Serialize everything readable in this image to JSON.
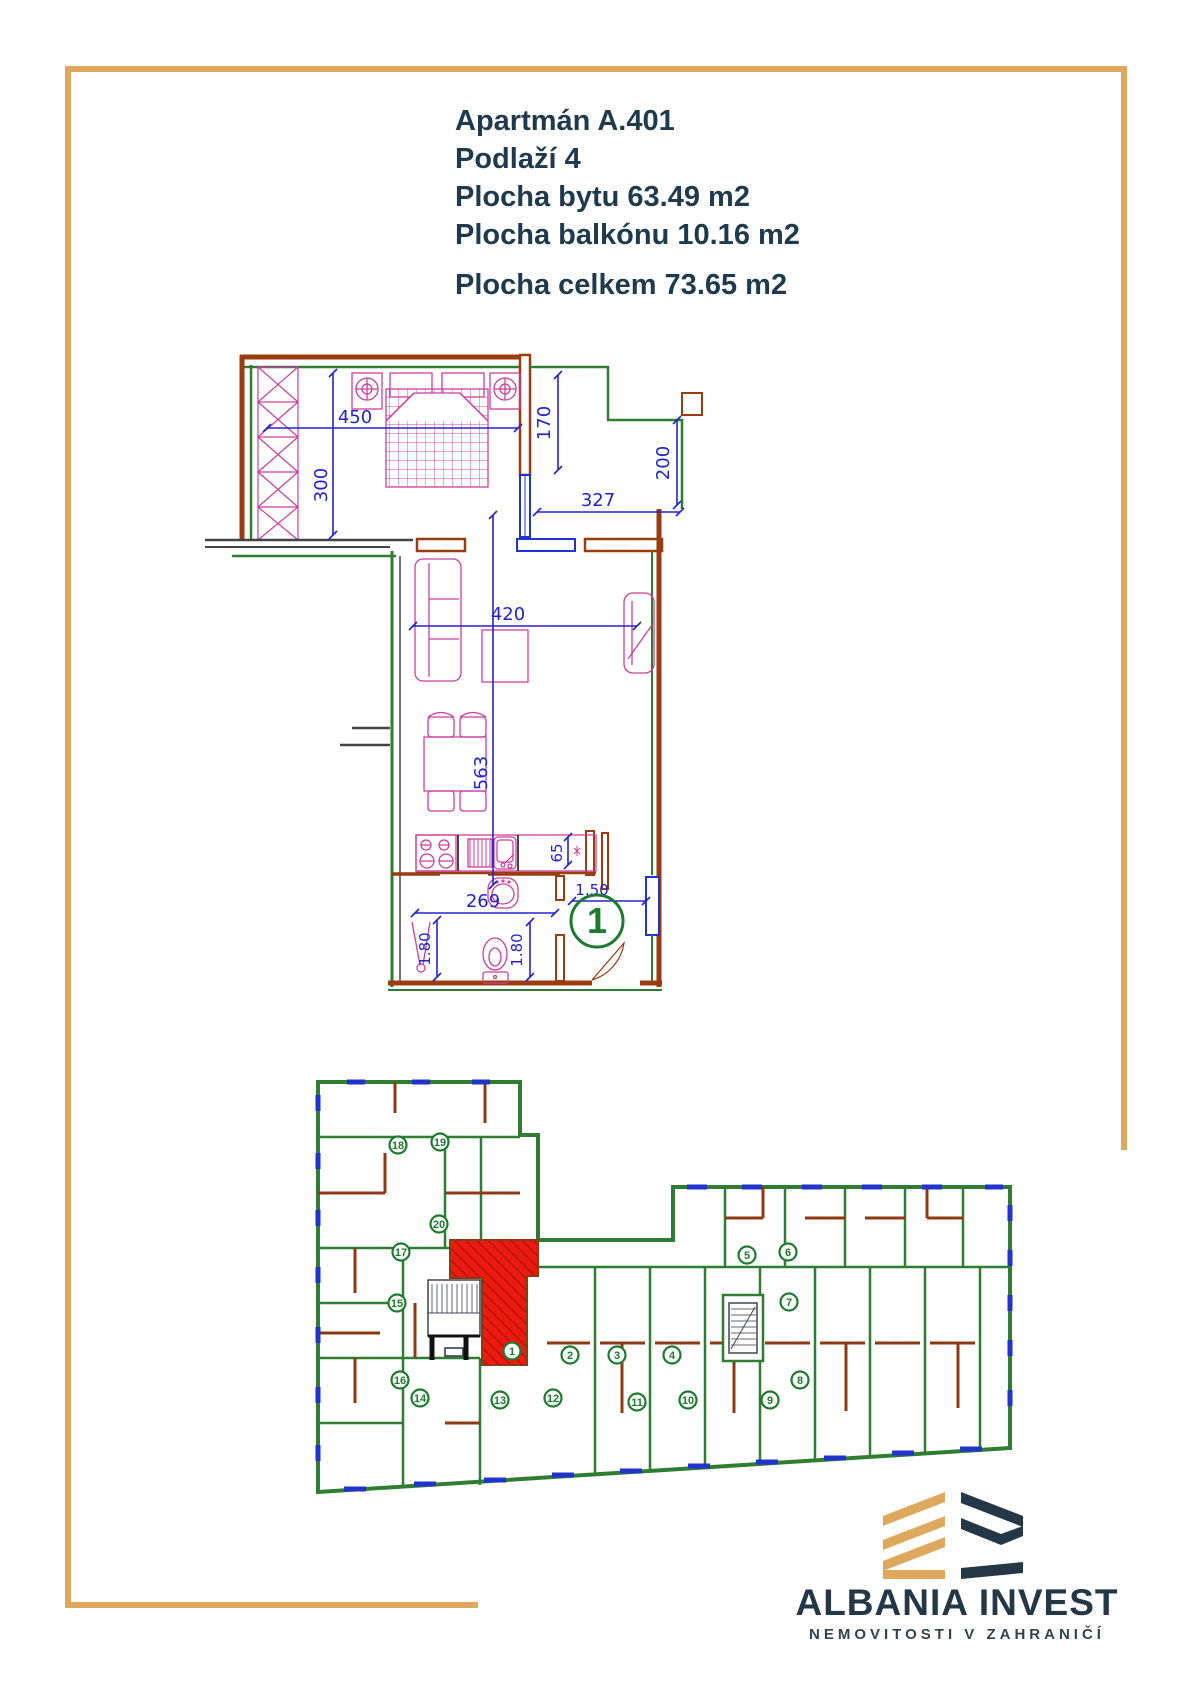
{
  "header": {
    "line1": "Apartmán A.401",
    "line2": "Podlaží 4",
    "line3": "Plocha bytu 63.49 m2",
    "line4": "Plocha balkónu 10.16 m2",
    "line5": "Plocha celkem 73.65 m2"
  },
  "apartment_plan": {
    "unit_marker": "1",
    "dims": {
      "bedroom_width": "450",
      "bedroom_depth": "300",
      "terrace_left_depth": "170",
      "terrace_width": "327",
      "terrace_right_depth": "200",
      "living_width": "420",
      "living_length": "563",
      "counter_depth": "65",
      "bathroom_width": "269",
      "shower_side": "1.80",
      "wc_side": "1.80",
      "hall_width": "1.50"
    }
  },
  "building_plan": {
    "highlighted_unit": "1",
    "markers": [
      "1",
      "2",
      "3",
      "4",
      "5",
      "6",
      "7",
      "8",
      "9",
      "10",
      "11",
      "12",
      "13",
      "14",
      "15",
      "16",
      "17",
      "18",
      "19",
      "20"
    ]
  },
  "logo": {
    "brand": "ALBANIA INVEST",
    "tagline": "NEMOVITOSTI V ZAHRANIČÍ"
  },
  "colors": {
    "frame_gold": "#DFA85F",
    "heading_navy": "#1F3A4C",
    "wall_brown": "#9A3B10",
    "wall_green": "#2E7D32",
    "dimension_blue": "#2323CD",
    "furniture_magenta": "#CC3F9E",
    "highlight_red": "#ED1B0F",
    "marker_green": "#1E7A2E",
    "logo_navy": "#243746"
  }
}
